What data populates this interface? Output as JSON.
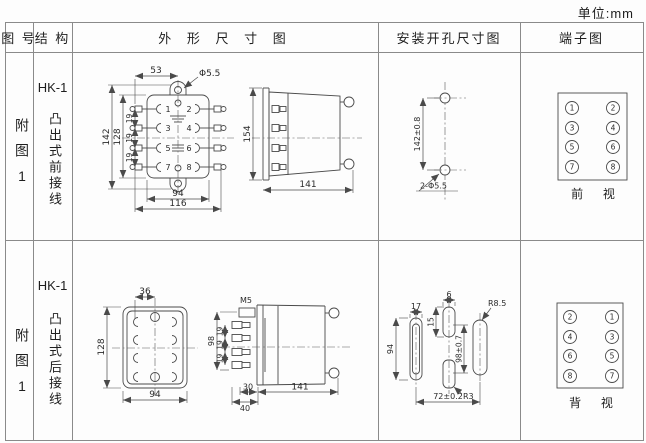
{
  "unit_label": "单位:mm",
  "colors": {
    "line": "#4a4a4a",
    "border": "#8a8a8a",
    "text": "#222222"
  },
  "header": {
    "figure_no": "图 号",
    "structure": "结 构",
    "outline": "外 形 尺 寸 图",
    "mounting": "安装开孔尺寸图",
    "terminal": "端子图"
  },
  "rows": [
    {
      "figure_no": "附图1",
      "model": "HK-1",
      "structure_desc": "凸出式前接线",
      "outline_front": {
        "top_offset": "53",
        "top_hole": "Φ5.5",
        "height_outer": "142",
        "height_inner": "128",
        "pitches": [
          "19",
          "19",
          "19"
        ],
        "width_inner": "94",
        "width_outer": "116",
        "terminal_numbers": [
          "1",
          "2",
          "3",
          "4",
          "5",
          "6",
          "7",
          "8"
        ]
      },
      "outline_side": {
        "height": "154",
        "depth": "141"
      },
      "mounting": {
        "vertical": "142±0.8",
        "holes": "2-Φ5.5"
      },
      "terminal": {
        "left_column": [
          "1",
          "3",
          "5",
          "7"
        ],
        "right_column": [
          "2",
          "4",
          "6",
          "8"
        ],
        "view_label": "前 视"
      }
    },
    {
      "figure_no": "附图1",
      "model": "HK-1",
      "structure_desc": "凸出式后接线",
      "outline_front": {
        "top_offset": "36",
        "height": "128",
        "width": "94"
      },
      "outline_side": {
        "thread": "M5",
        "height": "98",
        "pitches": [
          "19",
          "19",
          "19"
        ],
        "inner_width": "30",
        "outer_width": "40",
        "depth": "141"
      },
      "mounting": {
        "slot_width_left": "17",
        "slot_width_middle": "6",
        "slot_height_middle": "15",
        "slot_height_left": "94",
        "vertical": "98±0.7",
        "radius_right": "R8.5",
        "radius_middle": "R3",
        "horizontal": "72±0.2"
      },
      "terminal": {
        "left_column": [
          "2",
          "4",
          "6",
          "8"
        ],
        "right_column": [
          "1",
          "3",
          "5",
          "7"
        ],
        "view_label": "背 视"
      }
    }
  ]
}
